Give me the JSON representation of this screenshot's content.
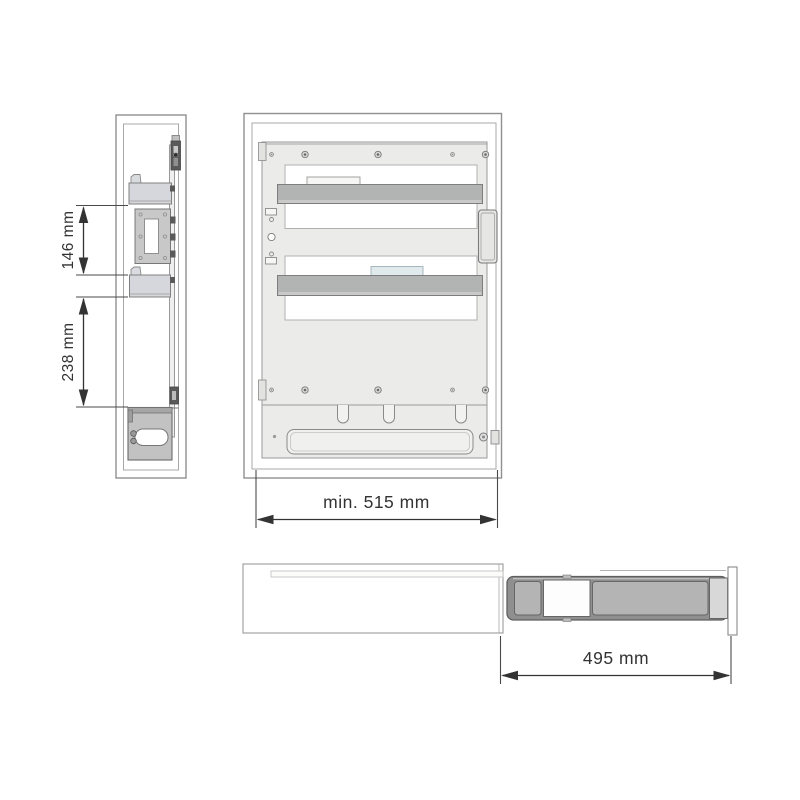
{
  "document": {
    "type": "technical-installation-drawing",
    "background": "#ffffff"
  },
  "diagram": {
    "side_view": {
      "name": "cabinet side section view",
      "dimensions": [
        {
          "id": "bracket-spacing-upper",
          "label": "146 mm",
          "orientation": "vertical"
        },
        {
          "id": "bracket-spacing-lower",
          "label": "238 mm",
          "orientation": "vertical"
        }
      ]
    },
    "front_view": {
      "name": "cabinet front view with pull-out frame",
      "dimension": {
        "id": "min-cabinet-height",
        "label": "min. 515 mm",
        "orientation": "horizontal"
      }
    },
    "top_view": {
      "name": "extended drawer top view",
      "dimension": {
        "id": "slide-length",
        "label": "495 mm",
        "orientation": "horizontal"
      }
    }
  },
  "colors": {
    "background": "#ffffff",
    "outline": "#8a8a8a",
    "dimension_line": "#333333",
    "panel_fill": "#ebebe9",
    "bar_fill": "#b2b4b3",
    "bracket_fill": "#d6d7dc",
    "plate_fill": "#c7c8c7",
    "unit_fill": "#b4b4b4",
    "dark_part": "#5a5a5a",
    "accent_blue": "#e0eaed"
  }
}
